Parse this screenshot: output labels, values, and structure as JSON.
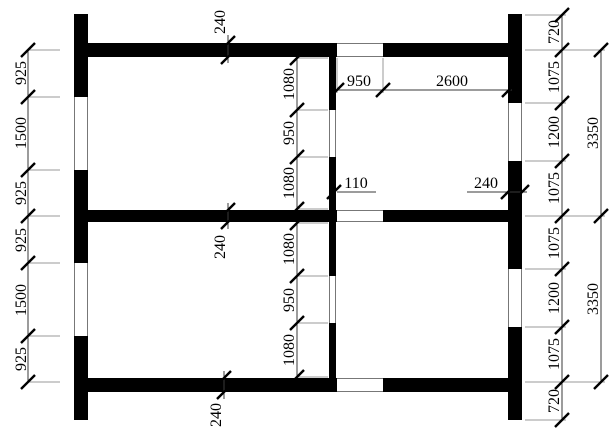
{
  "colors": {
    "wall": "#000000",
    "dimension_line": "#3a3a3a",
    "extension_line": "#9a9a9a",
    "text": "#000000",
    "background": "#ffffff"
  },
  "dimensions": {
    "left_chain": [
      "925",
      "1500",
      "925",
      "925",
      "1500",
      "925"
    ],
    "right_chain": [
      "720",
      "1075",
      "1200",
      "1075",
      "1075",
      "1200",
      "1075",
      "720"
    ],
    "right_totals": [
      "3350",
      "3350"
    ],
    "center_upper_chain": [
      "1080",
      "950",
      "1080"
    ],
    "center_lower_chain": [
      "1080",
      "950",
      "1080"
    ],
    "top_wall_thickness": "240",
    "middle_wall_thickness": "240",
    "bottom_wall_thickness": "240",
    "door_width": "950",
    "room_width": "2600",
    "partition_thickness": "110",
    "right_wall_thickness": "240"
  }
}
